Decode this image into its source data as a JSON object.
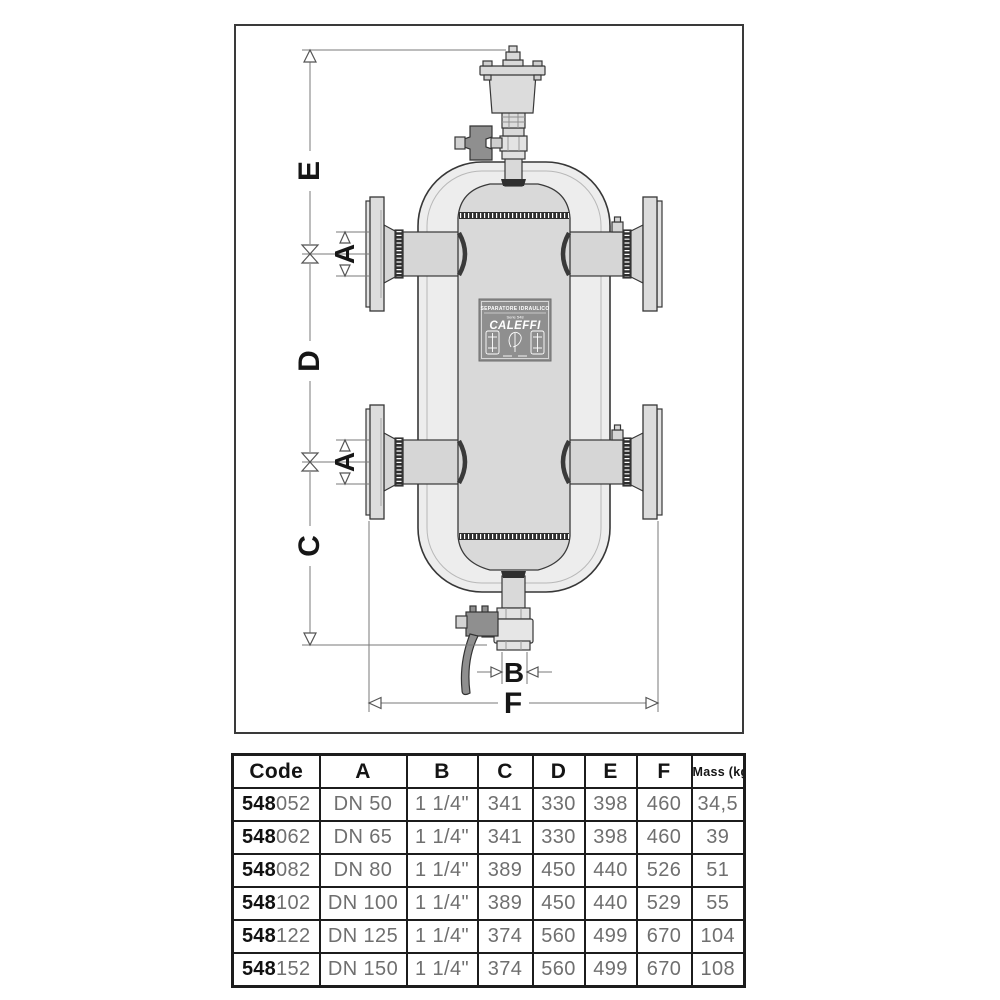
{
  "diagram": {
    "dims": {
      "e": "E",
      "d": "D",
      "c": "C",
      "a_top": "A",
      "a_bottom": "A",
      "b": "B",
      "f": "F"
    },
    "plate": {
      "title": "SEPARATORE IDRAULICO",
      "subtitle": "Serie 548",
      "brand": "CALEFFI"
    },
    "colors": {
      "outline": "#373737",
      "vessel_fill": "#ededed",
      "barrel_fill": "#d9d9d9",
      "metal_fill": "#dcdcdc",
      "handle_fill": "#8f8f8f",
      "plate_fill": "#8f8f8f",
      "dim_line": "#7a7a7a"
    }
  },
  "table": {
    "headers": [
      "Code",
      "A",
      "B",
      "C",
      "D",
      "E",
      "F",
      "Mass (kg)"
    ],
    "rows": [
      {
        "code_prefix": "548",
        "code_suffix": "052",
        "a": "DN 50",
        "b": "1 1/4\"",
        "c": "341",
        "d": "330",
        "e": "398",
        "f": "460",
        "mass": "34,5"
      },
      {
        "code_prefix": "548",
        "code_suffix": "062",
        "a": "DN 65",
        "b": "1 1/4\"",
        "c": "341",
        "d": "330",
        "e": "398",
        "f": "460",
        "mass": "39"
      },
      {
        "code_prefix": "548",
        "code_suffix": "082",
        "a": "DN 80",
        "b": "1 1/4\"",
        "c": "389",
        "d": "450",
        "e": "440",
        "f": "526",
        "mass": "51"
      },
      {
        "code_prefix": "548",
        "code_suffix": "102",
        "a": "DN 100",
        "b": "1 1/4\"",
        "c": "389",
        "d": "450",
        "e": "440",
        "f": "529",
        "mass": "55"
      },
      {
        "code_prefix": "548",
        "code_suffix": "122",
        "a": "DN 125",
        "b": "1 1/4\"",
        "c": "374",
        "d": "560",
        "e": "499",
        "f": "670",
        "mass": "104"
      },
      {
        "code_prefix": "548",
        "code_suffix": "152",
        "a": "DN 150",
        "b": "1 1/4\"",
        "c": "374",
        "d": "560",
        "e": "499",
        "f": "670",
        "mass": "108"
      }
    ]
  }
}
